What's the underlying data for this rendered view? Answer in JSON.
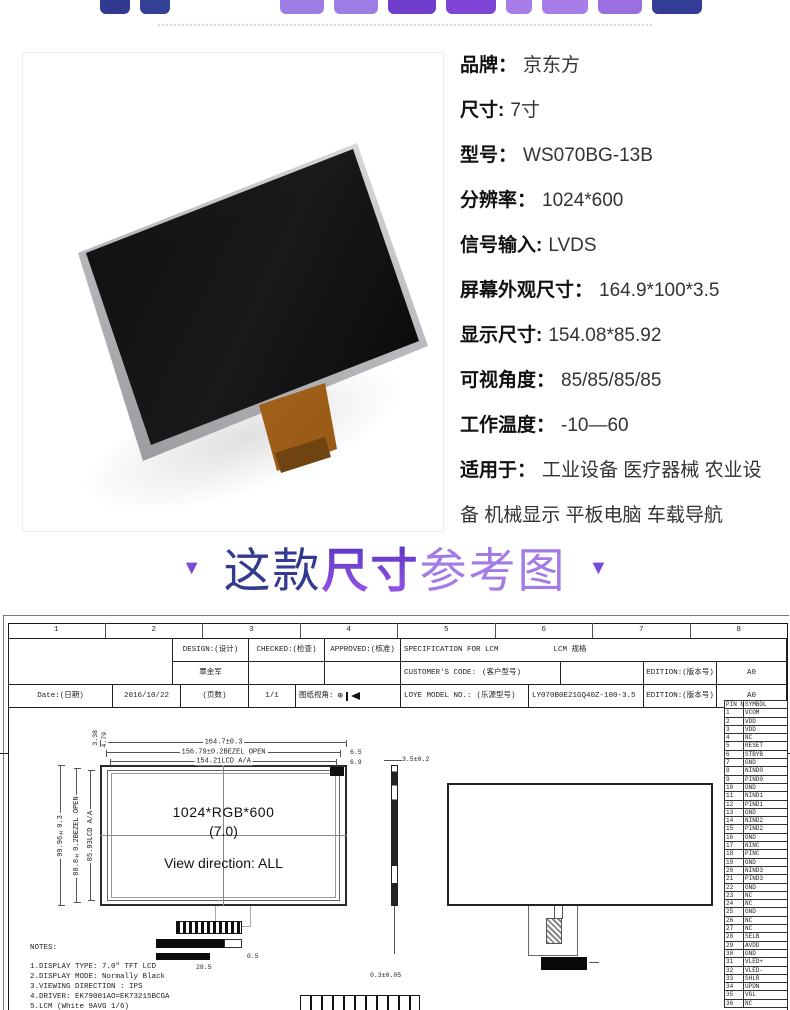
{
  "specs": {
    "rows": [
      {
        "label": "品牌：",
        "value": "京东方"
      },
      {
        "label": "尺寸:",
        "value": "7寸"
      },
      {
        "label": "型号：",
        "value": "WS070BG-13B"
      },
      {
        "label": "分辨率：",
        "value": "1024*600"
      },
      {
        "label": "信号输入:",
        "value": "LVDS"
      },
      {
        "label": "屏幕外观尺寸：",
        "value": "164.9*100*3.5"
      },
      {
        "label": "显示尺寸:",
        "value": "154.08*85.92"
      },
      {
        "label": "可视角度：",
        "value": "85/85/85/85"
      },
      {
        "label": "工作温度：",
        "value": "-10—60"
      },
      {
        "label": "适用于：",
        "value": "工业设备 医疗器械 农业设备 机械显示 平板电脑 车载导航"
      }
    ]
  },
  "section_title": {
    "arrow": "▼",
    "prefix": "这款",
    "emphasis": "尺寸",
    "suffix": "参考图"
  },
  "theme": {
    "accent_navy": "#333a90",
    "accent_purple": "#7b3fd4",
    "accent_light_purple": "#a47ae6"
  },
  "drawing": {
    "zone_numbers": [
      "1",
      "2",
      "3",
      "4",
      "5",
      "6",
      "7",
      "8"
    ],
    "zone_letter_left": "D",
    "zone_letter_right": "B",
    "title_block": {
      "design_label": "DESIGN:(设计)",
      "checked_label": "CHECKED:(检查)",
      "approved_label": "APPROVED:(核准)",
      "designer": "覃金军",
      "spec_title": "SPECIFICATION FOR LCM",
      "spec_title_cn": "LCM 规格",
      "customer_code_label": "CUSTOMER'S CODE:",
      "customer_code_cn": "(客户型号)",
      "edition_label": "EDITION:(版本号)",
      "edition_value": "A0",
      "model_label": "LOYE  MODEL NO.:",
      "model_label_cn": "(乐源型号)",
      "model_value": "LY070B0E21GQ40Z-100-3.5",
      "date_label": "Date:(日期)",
      "date_value": "2016/10/22",
      "pages_label": "(页数)",
      "pages_value": "1/1",
      "view_angle_label": "图纸视角:"
    },
    "front_view": {
      "dim_width_outline": "164.7±0.3",
      "dim_width_bezel": "156.79±0.2BEZEL OPEN",
      "dim_width_active": "154.21LCD A/A",
      "dim_right_top": "6.5",
      "dim_right_bottom": "6.9",
      "dim_height_outline": "99.96±0.3",
      "dim_height_bezel": "88.8±0.2BEZEL OPEN",
      "dim_height_active": "85.93LCD A/A",
      "dim_corner_a": "3.38",
      "dim_corner_b": "4.79",
      "label_resolution": "1024*RGB*600",
      "label_size": "(7.0)",
      "label_view": "View direction: ALL",
      "dim_tail_width": "28.5",
      "dim_tail_offset": "0.5"
    },
    "side_view": {
      "dim_thickness": "3.5±0.2",
      "dim_fpc": "0.3±0.05"
    },
    "notes": {
      "heading": "NOTES:",
      "items": [
        "1.DISPLAY TYPE: 7.0\" TFT LCD",
        "2.DISPLAY MODE: Normally Black",
        "3.VIEWING DIRECTION : IPS",
        "4.DRIVER: EK79001AO=EK73215BCGA",
        "5.LCM (White 9AVG 1/6)"
      ]
    },
    "pin_table": {
      "headers": [
        "PIN NO",
        "SYMBOL"
      ],
      "rows": [
        {
          "no": "1",
          "sym": "VCOM"
        },
        {
          "no": "2",
          "sym": "VDD"
        },
        {
          "no": "3",
          "sym": "VDD"
        },
        {
          "no": "4",
          "sym": "NC"
        },
        {
          "no": "5",
          "sym": "RESET"
        },
        {
          "no": "6",
          "sym": "STBYB"
        },
        {
          "no": "7",
          "sym": "GND"
        },
        {
          "no": "8",
          "sym": "NIND0"
        },
        {
          "no": "9",
          "sym": "PIND0"
        },
        {
          "no": "10",
          "sym": "GND"
        },
        {
          "no": "11",
          "sym": "NIND1"
        },
        {
          "no": "12",
          "sym": "PIND1"
        },
        {
          "no": "13",
          "sym": "GND"
        },
        {
          "no": "14",
          "sym": "NIND2"
        },
        {
          "no": "15",
          "sym": "PIND2"
        },
        {
          "no": "16",
          "sym": "GND"
        },
        {
          "no": "17",
          "sym": "NINC"
        },
        {
          "no": "18",
          "sym": "PINC"
        },
        {
          "no": "19",
          "sym": "GND"
        },
        {
          "no": "20",
          "sym": "NIND3"
        },
        {
          "no": "21",
          "sym": "PIND3"
        },
        {
          "no": "22",
          "sym": "GND"
        },
        {
          "no": "23",
          "sym": "NC"
        },
        {
          "no": "24",
          "sym": "NC"
        },
        {
          "no": "25",
          "sym": "GND"
        },
        {
          "no": "26",
          "sym": "NC"
        },
        {
          "no": "27",
          "sym": "NC"
        },
        {
          "no": "28",
          "sym": "SELB"
        },
        {
          "no": "29",
          "sym": "AVDD"
        },
        {
          "no": "30",
          "sym": "GND"
        },
        {
          "no": "31",
          "sym": "VLED+"
        },
        {
          "no": "32",
          "sym": "VLED-"
        },
        {
          "no": "33",
          "sym": "SHLR"
        },
        {
          "no": "34",
          "sym": "UPDN"
        },
        {
          "no": "35",
          "sym": "VGL"
        },
        {
          "no": "36",
          "sym": "NC"
        }
      ]
    }
  }
}
